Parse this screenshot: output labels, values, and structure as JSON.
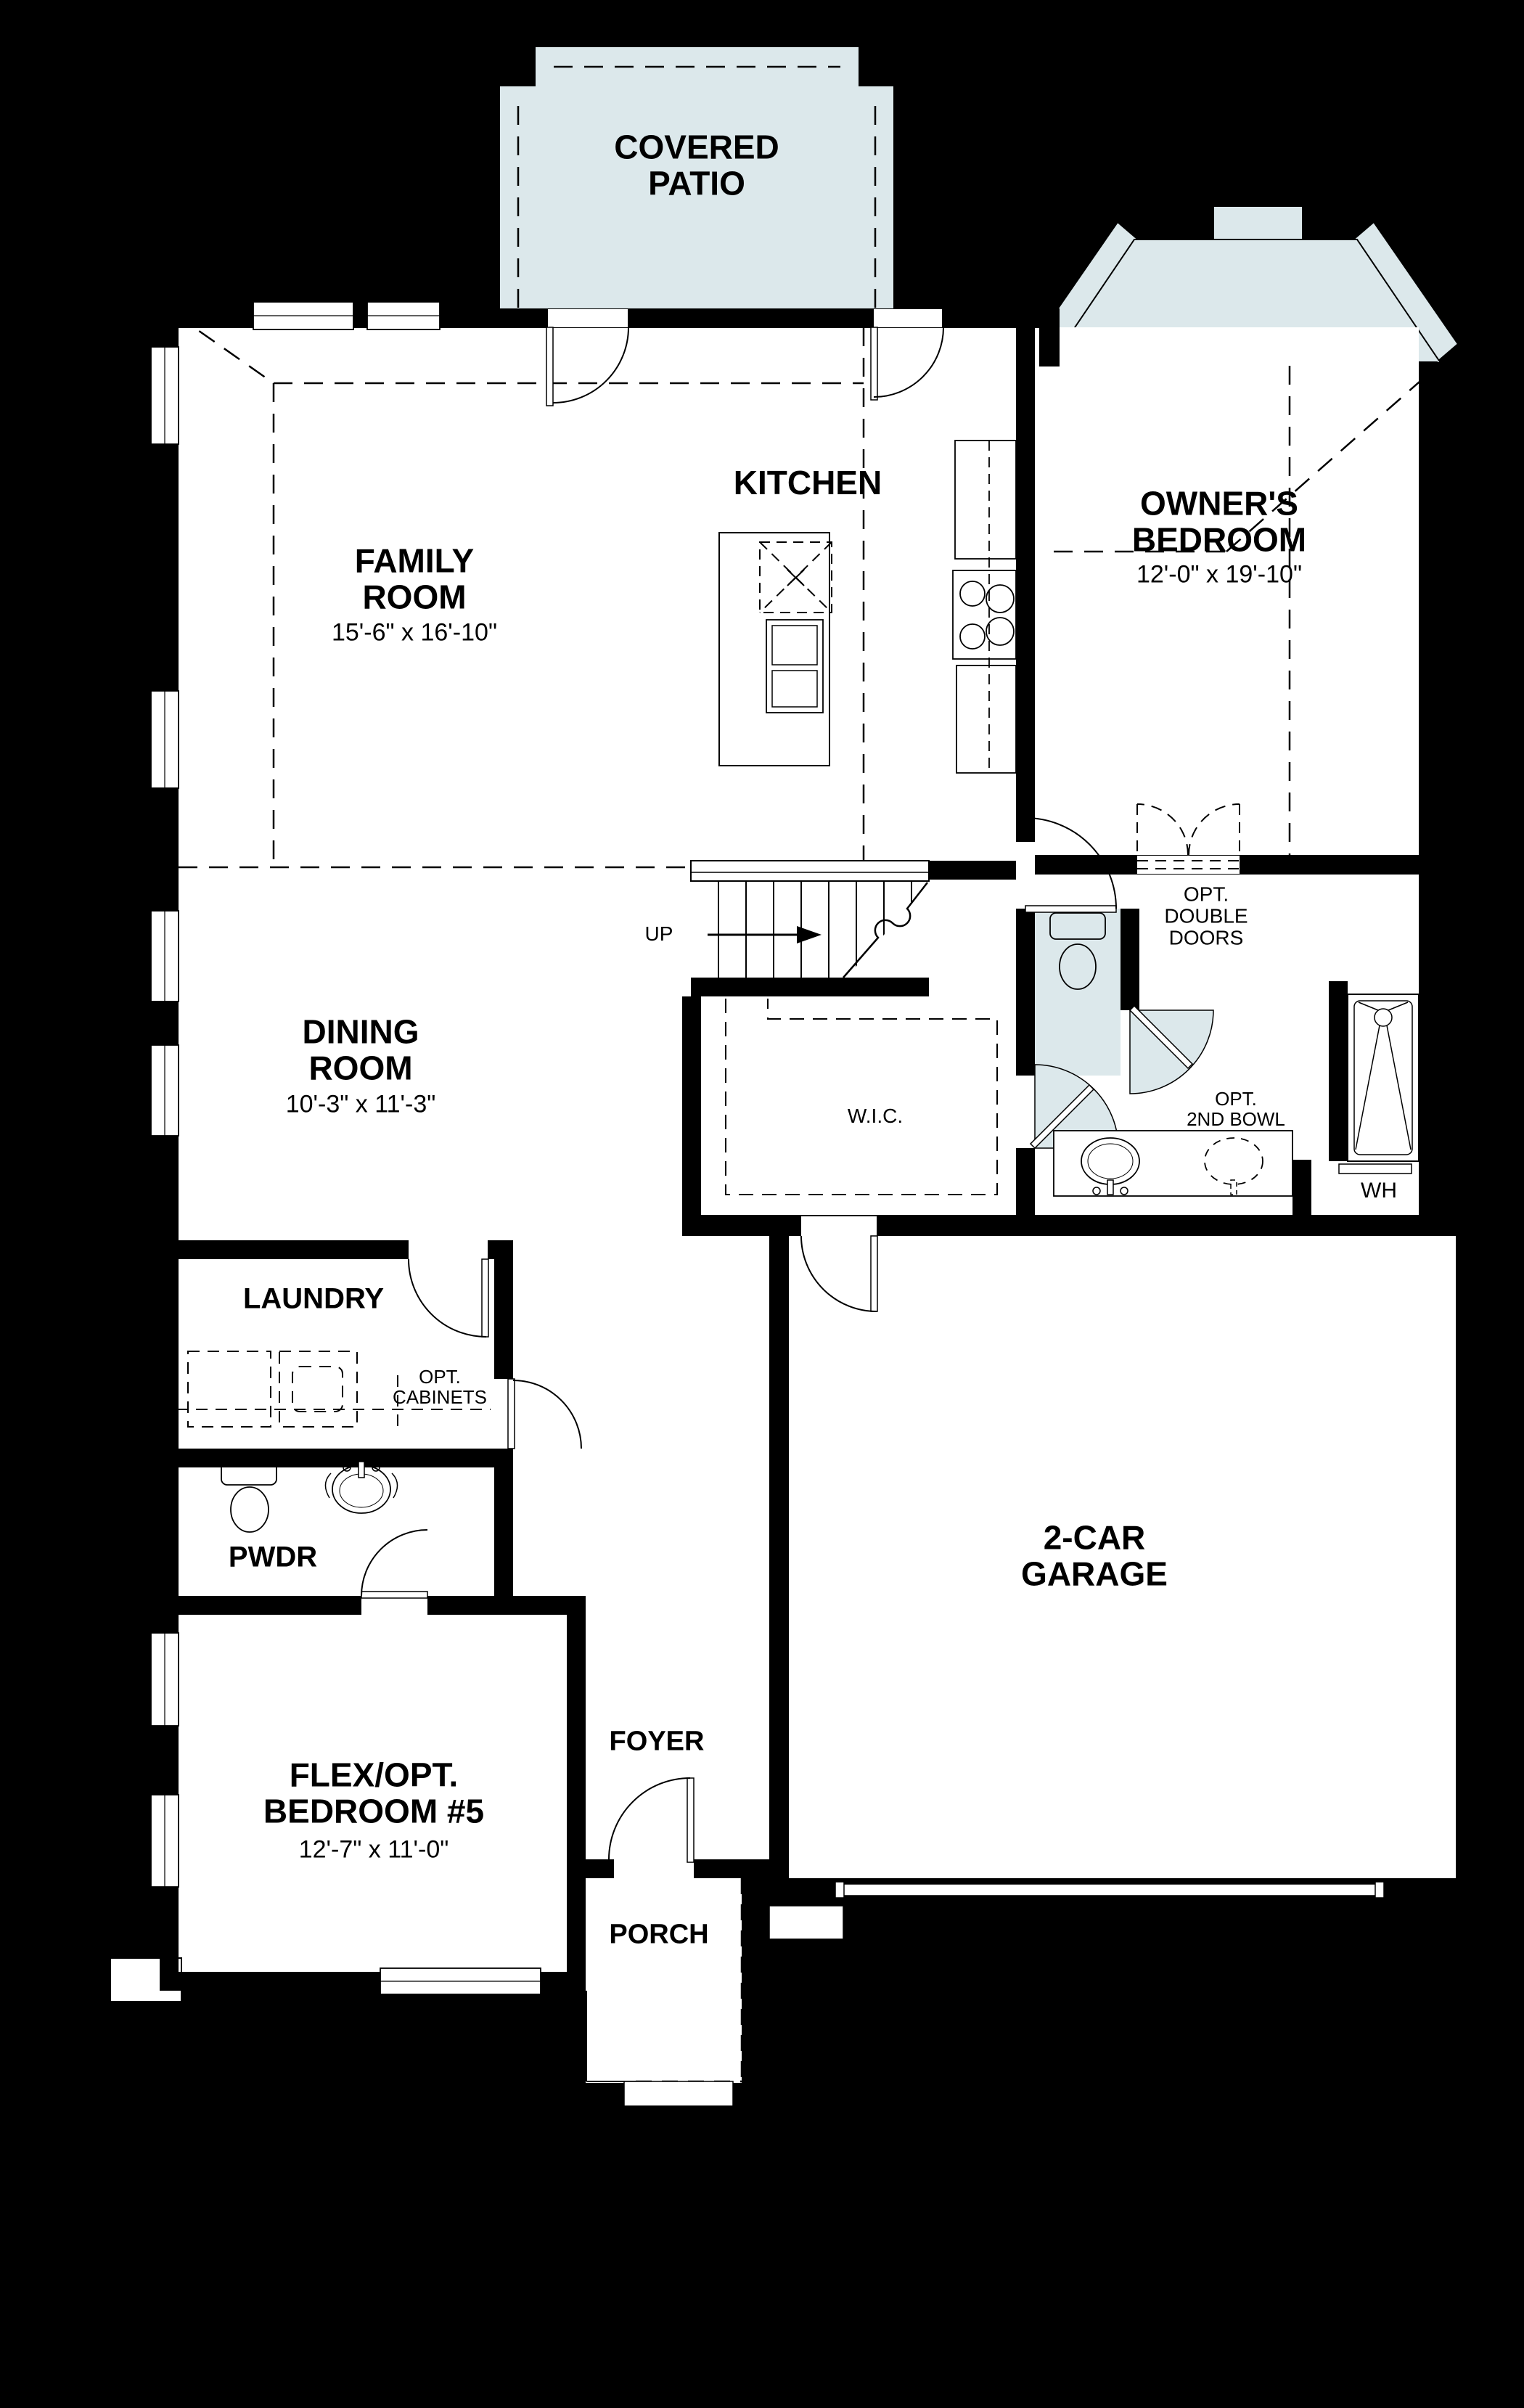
{
  "plan": {
    "type": "first-floor residential floor plan",
    "colors": {
      "background": "#000000",
      "floor": "#ffffff",
      "wall": "#000000",
      "patio_fill": "#dce8eb",
      "line": "#000000"
    },
    "rooms": {
      "covered_patio": {
        "line1": "COVERED",
        "line2": "PATIO"
      },
      "kitchen": {
        "line1": "KITCHEN"
      },
      "family": {
        "line1": "FAMILY",
        "line2": "ROOM",
        "dims": "15'-6\" x 16'-10\""
      },
      "owners": {
        "line1": "OWNER'S",
        "line2": "BEDROOM",
        "dims": "12'-0\" x 19'-10\""
      },
      "dining": {
        "line1": "DINING",
        "line2": "ROOM",
        "dims": "10'-3\" x 11'-3\""
      },
      "garage": {
        "line1": "2-CAR",
        "line2": "GARAGE"
      },
      "flex": {
        "line1": "FLEX/OPT.",
        "line2": "BEDROOM #5",
        "dims": "12'-7\" x 11'-0\""
      },
      "laundry": {
        "line1": "LAUNDRY"
      },
      "pwdr": {
        "line1": "PWDR"
      },
      "foyer": {
        "line1": "FOYER"
      },
      "porch": {
        "line1": "PORCH"
      }
    },
    "annotations": {
      "up": "UP",
      "wic": "W.I.C.",
      "wh": "WH",
      "opt_double_doors": {
        "line1": "OPT.",
        "line2": "DOUBLE",
        "line3": "DOORS"
      },
      "opt_2nd_bowl": {
        "line1": "OPT.",
        "line2": "2ND BOWL"
      },
      "opt_cabinets": {
        "line1": "OPT.",
        "line2": "CABINETS"
      }
    }
  }
}
